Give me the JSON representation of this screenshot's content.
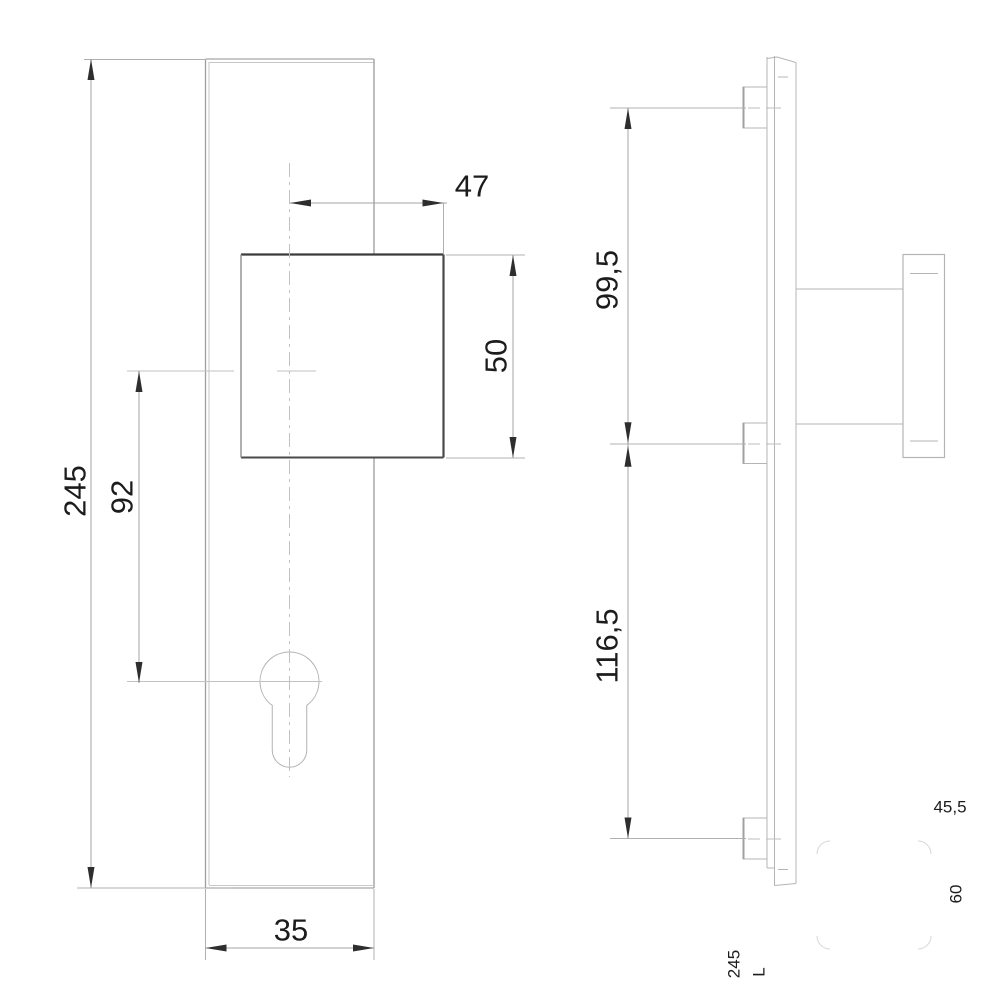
{
  "drawing": {
    "type": "technical-drawing",
    "subject": "security-plate-with-square-knob-and-euro-cylinder-hole",
    "views": [
      "front-view",
      "side-view"
    ],
    "front_view": {
      "plate_height_mm": "245",
      "knob_center_to_cylinder_mm": "92",
      "center_to_knob_edge_mm": "47",
      "knob_size_mm": "50",
      "plate_width_mm": "35"
    },
    "side_view": {
      "top_fixing_to_knob_center_mm": "99,5",
      "knob_center_to_bottom_fixing_mm": "116,5"
    },
    "margin_notes": {
      "note_45_5": "45,5",
      "note_60": "60",
      "note_245": "245",
      "note_l": "L"
    },
    "colors": {
      "background": "#ffffff",
      "outline_gray": "#aeaeae",
      "light_line": "#c6c6c6",
      "dimension_line": "#a5a5a5",
      "centerline": "#c2c2c2",
      "arrow_and_text": "#2e2e2e",
      "knob_outline_dark": "#3c3c3c",
      "ghost_line": "#d6d6d6"
    }
  }
}
